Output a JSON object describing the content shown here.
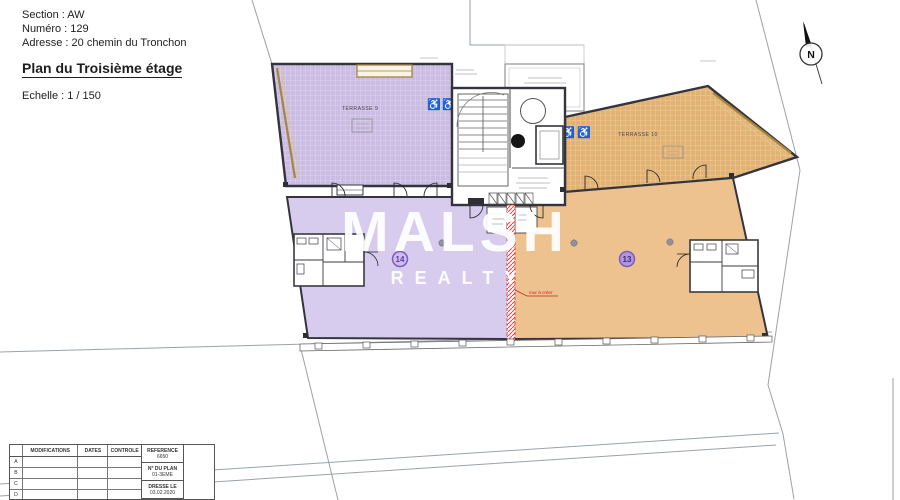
{
  "header": {
    "section": "Section : AW",
    "numero": "Numéro : 129",
    "adresse": "Adresse : 20 chemin du Tronchon",
    "title": "Plan du Troisième étage",
    "echelle": "Echelle  : 1 / 150"
  },
  "plan": {
    "terrasse9_label": "TERRASSE 9",
    "terrasse10_label": "TERRASSE 10",
    "lot14_number": "14",
    "lot13_number": "13",
    "mur_a_creer_label": "mur à créer",
    "north_letter": "N"
  },
  "icons": {
    "wheelchair": "♿"
  },
  "watermark": {
    "line1": "MALSH",
    "line2": "REALTY"
  },
  "titleblock": {
    "headers": [
      "MODIFICATIONS",
      "DATES",
      "CONTROLE"
    ],
    "row_letters": [
      "A",
      "B",
      "C",
      "D",
      "E"
    ],
    "reference_label": "REFERENCE",
    "reference_value": "6650",
    "plan_no_label": "N° DU PLAN",
    "plan_no_value": "01-3EME",
    "issued_label": "DRESSE LE",
    "issued_value": "03.02.2020"
  },
  "colors": {
    "terrace_purple": "#cabce2",
    "interior_purple": "#d8ccee",
    "terrace_orange": "#e2b275",
    "interior_orange": "#eec28e",
    "wall": "#34343e",
    "new_wall_red": "#d03030",
    "gold_band": "#a5863a",
    "badge_purple": "#7a5cc4",
    "watermark_white": "#ffffff"
  }
}
